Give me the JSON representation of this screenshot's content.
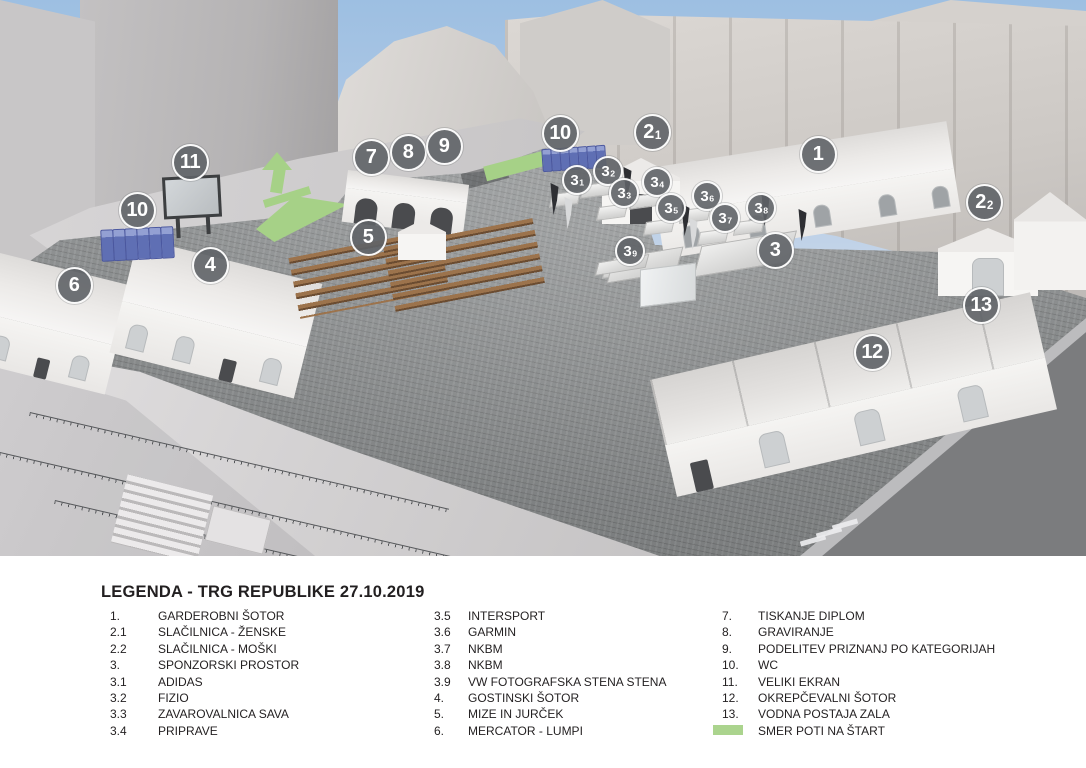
{
  "legend": {
    "title": "LEGENDA - TRG REPUBLIKE 27.10.2019",
    "swatch_color": "#abd48e",
    "columns": [
      {
        "items": [
          {
            "num": "1.",
            "label": "GARDEROBNI ŠOTOR"
          },
          {
            "num": "2.1",
            "label": "SLAČILNICA - ŽENSKE"
          },
          {
            "num": "2.2",
            "label": "SLAČILNICA - MOŠKI"
          },
          {
            "num": "3.",
            "label": "SPONZORSKI PROSTOR"
          },
          {
            "num": "3.1",
            "label": "ADIDAS"
          },
          {
            "num": "3.2",
            "label": "FIZIO"
          },
          {
            "num": "3.3",
            "label": "ZAVAROVALNICA SAVA"
          },
          {
            "num": "3.4",
            "label": "PRIPRAVE"
          }
        ]
      },
      {
        "items": [
          {
            "num": "3.5",
            "label": "INTERSPORT"
          },
          {
            "num": "3.6",
            "label": "GARMIN"
          },
          {
            "num": "3.7",
            "label": "NKBM"
          },
          {
            "num": "3.8",
            "label": "NKBM"
          },
          {
            "num": "3.9",
            "label": "VW FOTOGRAFSKA STENA STENA"
          },
          {
            "num": "4.",
            "label": "GOSTINSKI ŠOTOR"
          },
          {
            "num": "5.",
            "label": "MIZE IN JURČEK"
          },
          {
            "num": "6.",
            "label": "MERCATOR - LUMPI"
          }
        ]
      },
      {
        "items": [
          {
            "num": "7.",
            "label": "TISKANJE DIPLOM"
          },
          {
            "num": "8.",
            "label": "GRAVIRANJE"
          },
          {
            "num": "9.",
            "label": "PODELITEV PRIZNANJ PO KATEGORIJAH"
          },
          {
            "num": "10.",
            "label": "WC"
          },
          {
            "num": "11.",
            "label": "VELIKI EKRAN"
          },
          {
            "num": "12.",
            "label": "OKREPČEVALNI ŠOTOR"
          },
          {
            "num": "13.",
            "label": "VODNA POSTAJA ZALA"
          },
          {
            "num": "",
            "label": "SMER POTI NA ŠTART",
            "swatch": true
          }
        ]
      }
    ]
  },
  "scene": {
    "colors": {
      "marker_fill": "#5f6367",
      "marker_border": "#ffffff",
      "route_green": "#a6d187",
      "sky": "#9dbfe2",
      "legend_text": "#221f20"
    },
    "markers": [
      {
        "name": "marker-1",
        "label": "1",
        "sub": "",
        "x": 818,
        "y": 154,
        "size": "lg"
      },
      {
        "name": "marker-2-1",
        "label": "2",
        "sub": "1",
        "x": 652,
        "y": 132,
        "size": "lg"
      },
      {
        "name": "marker-2-2",
        "label": "2",
        "sub": "2",
        "x": 984,
        "y": 202,
        "size": "lg"
      },
      {
        "name": "marker-3",
        "label": "3",
        "sub": "",
        "x": 775,
        "y": 250,
        "size": "lg"
      },
      {
        "name": "marker-3-1",
        "label": "3",
        "sub": "1",
        "x": 577,
        "y": 180,
        "size": "sm"
      },
      {
        "name": "marker-3-2",
        "label": "3",
        "sub": "2",
        "x": 608,
        "y": 171,
        "size": "sm"
      },
      {
        "name": "marker-3-3",
        "label": "3",
        "sub": "3",
        "x": 624,
        "y": 193,
        "size": "sm"
      },
      {
        "name": "marker-3-4",
        "label": "3",
        "sub": "4",
        "x": 657,
        "y": 182,
        "size": "sm"
      },
      {
        "name": "marker-3-5",
        "label": "3",
        "sub": "5",
        "x": 671,
        "y": 208,
        "size": "sm"
      },
      {
        "name": "marker-3-6",
        "label": "3",
        "sub": "6",
        "x": 707,
        "y": 196,
        "size": "sm"
      },
      {
        "name": "marker-3-7",
        "label": "3",
        "sub": "7",
        "x": 725,
        "y": 218,
        "size": "sm"
      },
      {
        "name": "marker-3-8",
        "label": "3",
        "sub": "8",
        "x": 761,
        "y": 208,
        "size": "sm"
      },
      {
        "name": "marker-3-9",
        "label": "3",
        "sub": "9",
        "x": 630,
        "y": 251,
        "size": "sm"
      },
      {
        "name": "marker-4",
        "label": "4",
        "sub": "",
        "x": 210,
        "y": 265,
        "size": "lg"
      },
      {
        "name": "marker-5",
        "label": "5",
        "sub": "",
        "x": 368,
        "y": 237,
        "size": "lg"
      },
      {
        "name": "marker-6",
        "label": "6",
        "sub": "",
        "x": 74,
        "y": 285,
        "size": "lg"
      },
      {
        "name": "marker-7",
        "label": "7",
        "sub": "",
        "x": 371,
        "y": 157,
        "size": "lg"
      },
      {
        "name": "marker-8",
        "label": "8",
        "sub": "",
        "x": 408,
        "y": 152,
        "size": "lg"
      },
      {
        "name": "marker-9",
        "label": "9",
        "sub": "",
        "x": 444,
        "y": 146,
        "size": "lg"
      },
      {
        "name": "marker-10-top",
        "label": "10",
        "sub": "",
        "x": 560,
        "y": 133,
        "size": "lg"
      },
      {
        "name": "marker-10-left",
        "label": "10",
        "sub": "",
        "x": 137,
        "y": 210,
        "size": "lg"
      },
      {
        "name": "marker-11",
        "label": "11",
        "sub": "",
        "x": 190,
        "y": 162,
        "size": "lg"
      },
      {
        "name": "marker-12",
        "label": "12",
        "sub": "",
        "x": 872,
        "y": 352,
        "size": "lg"
      },
      {
        "name": "marker-13",
        "label": "13",
        "sub": "",
        "x": 981,
        "y": 305,
        "size": "lg"
      }
    ]
  }
}
